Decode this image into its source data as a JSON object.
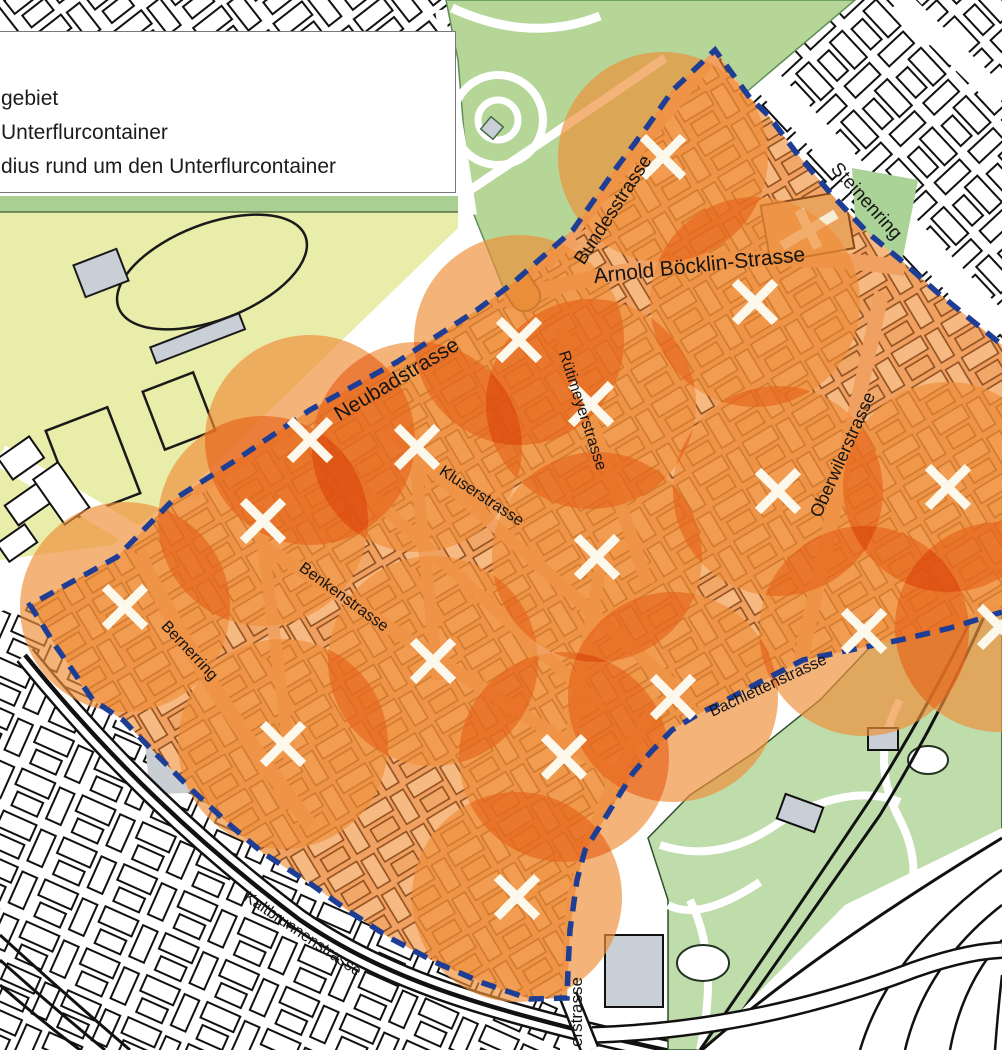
{
  "legend": {
    "items": [
      {
        "label": "gebiet"
      },
      {
        "label": "Unterflurcontainer"
      },
      {
        "label": "dius rund um den Unterflurcontainer"
      }
    ]
  },
  "map": {
    "street_labels": [
      {
        "name": "Bundesstrasse",
        "x": 618,
        "y": 213,
        "rotate": -57,
        "size": 19
      },
      {
        "name": "Steinenring",
        "x": 862,
        "y": 205,
        "rotate": 48,
        "size": 19
      },
      {
        "name": "Arnold Böcklin-Strasse",
        "x": 700,
        "y": 272,
        "rotate": -6,
        "size": 21
      },
      {
        "name": "Neubadstrasse",
        "x": 400,
        "y": 385,
        "rotate": -31,
        "size": 21
      },
      {
        "name": "Rütimeyerstrasse",
        "x": 578,
        "y": 412,
        "rotate": 72,
        "size": 16
      },
      {
        "name": "Kluserstrasse",
        "x": 479,
        "y": 500,
        "rotate": 33,
        "size": 16
      },
      {
        "name": "Oberwilerstrasse",
        "x": 848,
        "y": 457,
        "rotate": -66,
        "size": 18
      },
      {
        "name": "Benkenstrasse",
        "x": 341,
        "y": 601,
        "rotate": 36,
        "size": 16
      },
      {
        "name": "Bernerring",
        "x": 186,
        "y": 654,
        "rotate": 47,
        "size": 16
      },
      {
        "name": "Bachlettenstrasse",
        "x": 770,
        "y": 690,
        "rotate": -25,
        "size": 16
      },
      {
        "name": "Kaltbrunnenstrasse",
        "x": 300,
        "y": 938,
        "rotate": 34,
        "size": 16
      },
      {
        "name": "erstrasse",
        "x": 582,
        "y": 1012,
        "rotate": -90,
        "size": 17
      }
    ],
    "containers": [
      [
        663,
        157
      ],
      [
        755,
        302
      ],
      [
        519,
        340
      ],
      [
        591,
        404
      ],
      [
        310,
        440
      ],
      [
        417,
        447
      ],
      [
        263,
        521
      ],
      [
        948,
        487
      ],
      [
        778,
        491
      ],
      [
        597,
        557
      ],
      [
        125,
        607
      ],
      [
        433,
        661
      ],
      [
        864,
        631
      ],
      [
        673,
        697
      ],
      [
        283,
        744
      ],
      [
        564,
        757
      ],
      [
        517,
        897
      ],
      [
        1000,
        627
      ]
    ],
    "radius_px": 105,
    "boundary": [
      [
        1002,
        612
      ],
      [
        950,
        628
      ],
      [
        900,
        640
      ],
      [
        850,
        650
      ],
      [
        803,
        660
      ],
      [
        760,
        682
      ],
      [
        717,
        705
      ],
      [
        700,
        713
      ],
      [
        672,
        730
      ],
      [
        650,
        753
      ],
      [
        633,
        773
      ],
      [
        610,
        810
      ],
      [
        585,
        850
      ],
      [
        577,
        880
      ],
      [
        570,
        930
      ],
      [
        568,
        970
      ],
      [
        567,
        998
      ],
      [
        530,
        999
      ],
      [
        483,
        983
      ],
      [
        437,
        963
      ],
      [
        390,
        938
      ],
      [
        350,
        912
      ],
      [
        308,
        882
      ],
      [
        263,
        853
      ],
      [
        230,
        825
      ],
      [
        192,
        790
      ],
      [
        157,
        755
      ],
      [
        123,
        720
      ],
      [
        93,
        700
      ],
      [
        55,
        645
      ],
      [
        30,
        605
      ],
      [
        117,
        557
      ],
      [
        173,
        500
      ],
      [
        233,
        462
      ],
      [
        310,
        410
      ],
      [
        397,
        362
      ],
      [
        477,
        310
      ],
      [
        513,
        283
      ],
      [
        573,
        230
      ],
      [
        617,
        167
      ],
      [
        647,
        127
      ],
      [
        673,
        90
      ],
      [
        715,
        50
      ],
      [
        750,
        98
      ],
      [
        768,
        115
      ],
      [
        798,
        155
      ],
      [
        832,
        195
      ],
      [
        868,
        233
      ],
      [
        903,
        262
      ],
      [
        938,
        293
      ],
      [
        980,
        327
      ],
      [
        1002,
        345
      ]
    ],
    "colors": {
      "boundary_blue": "#1e3e96",
      "radius_fill": "#ef8f3a",
      "marker_white": "#fcf8ec",
      "area_street": "#f0a060",
      "area_building": "#f6b981",
      "area_outline": "#8a4a1a",
      "field_yellow": "#e9edaa",
      "park_green": "#b5d697",
      "zoo_green": "#bfdcab",
      "strip_green": "#a9cf92",
      "gray_building": "#c9cfd6"
    }
  }
}
